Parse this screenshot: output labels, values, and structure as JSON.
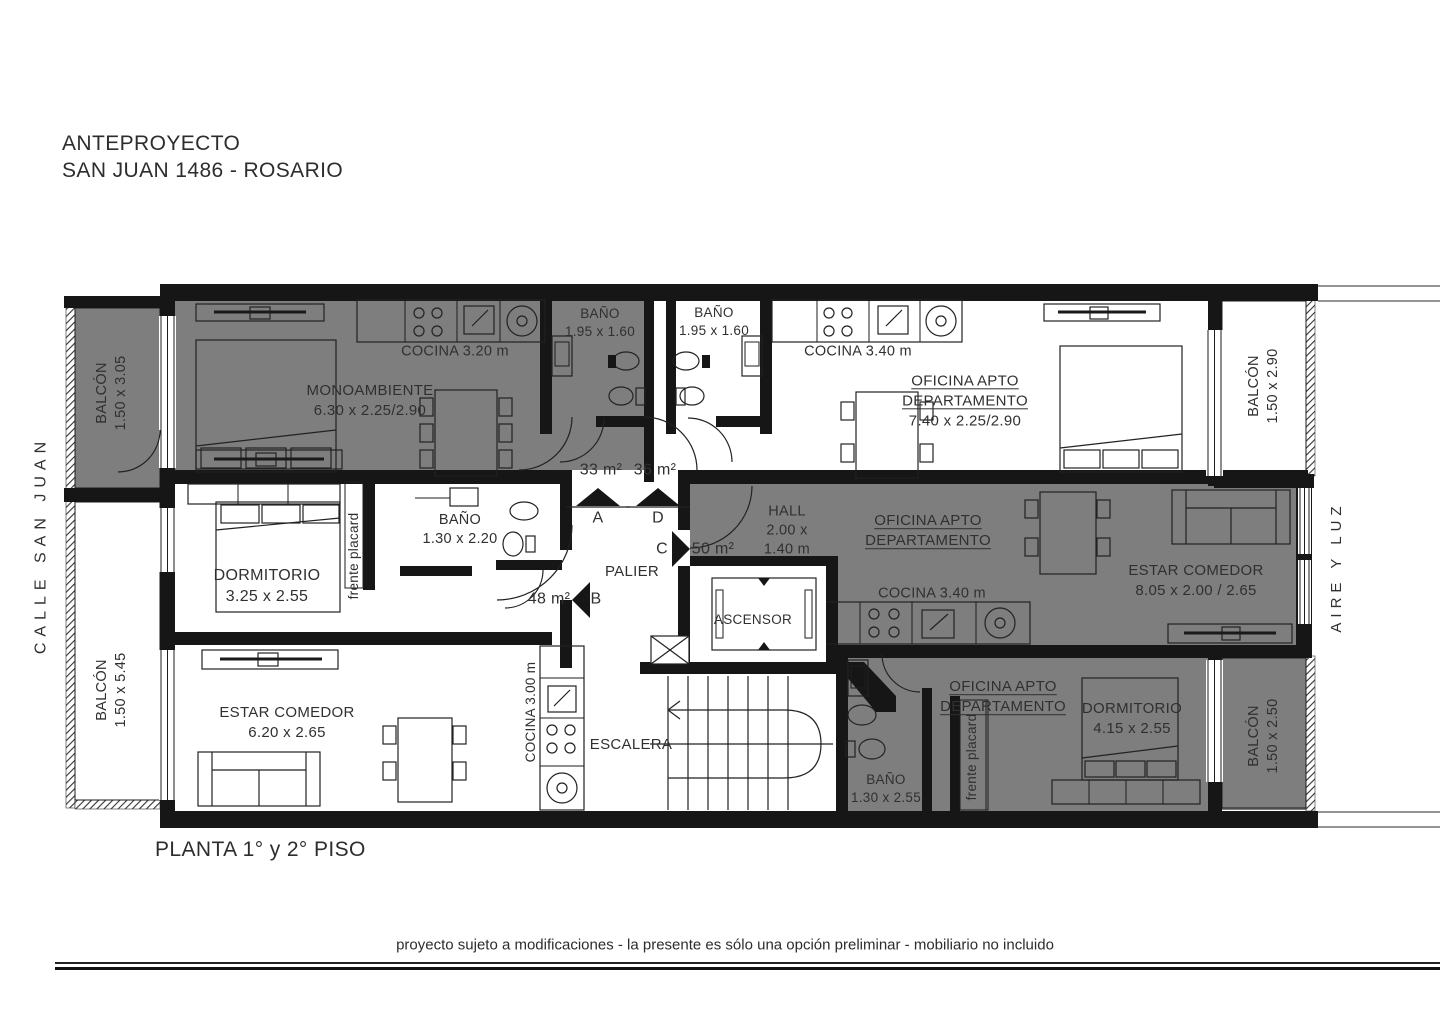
{
  "title": {
    "line1": "ANTEPROYECTO",
    "line2": "SAN JUAN 1486 - ROSARIO"
  },
  "surroundings": {
    "street": "CALLE SAN JUAN",
    "air_shaft": "AIRE Y LUZ"
  },
  "balconies": {
    "left_top": {
      "name": "BALCÓN",
      "dims": "1.50 x 3.05"
    },
    "left_bottom": {
      "name": "BALCÓN",
      "dims": "1.50 x 5.45"
    },
    "right_top": {
      "name": "BALCÓN",
      "dims": "1.50 x 2.90"
    },
    "right_bottom": {
      "name": "BALCÓN",
      "dims": "1.50 x 2.50"
    }
  },
  "unit_a": {
    "area": "33 m²",
    "entry": "A",
    "room": "MONOAMBIENTE",
    "room_dims": "6.30 x 2.25/2.90",
    "kitchen": "COCINA 3.20 m",
    "bath": "BAÑO",
    "bath_dims": "1.95 x 1.60"
  },
  "unit_d": {
    "area": "36 m²",
    "entry": "D",
    "office1": "OFICINA APTO",
    "office2": "DEPARTAMENTO",
    "room_dims": "7.40 x 2.25/2.90",
    "kitchen": "COCINA 3.40 m",
    "bath": "BAÑO",
    "bath_dims": "1.95 x 1.60"
  },
  "unit_b": {
    "area": "48 m²",
    "entry": "B",
    "bedroom": "DORMITORIO",
    "bedroom_dims": "3.25 x 2.55",
    "bath": "BAÑO",
    "bath_dims": "1.30 x 2.20",
    "placard": "frente placard",
    "living": "ESTAR COMEDOR",
    "living_dims": "6.20 x 2.65",
    "kitchen": "COCINA 3.00 m"
  },
  "unit_c": {
    "area": "50 m²",
    "entry": "C",
    "hall": "HALL",
    "hall_dims1": "2.00 x",
    "hall_dims2": "1.40 m",
    "office1": "OFICINA APTO",
    "office2": "DEPARTAMENTO",
    "kitchen": "COCINA 3.40 m",
    "living": "ESTAR COMEDOR",
    "living_dims": "8.05 x 2.00 / 2.65",
    "office1b": "OFICINA APTO",
    "office2b": "DEPARTAMENTO",
    "bedroom": "DORMITORIO",
    "bedroom_dims": "4.15 x 2.55",
    "bath": "BAÑO",
    "bath_dims": "1.30 x 2.55",
    "placard": "frente placard"
  },
  "core": {
    "landing": "PALIER",
    "elevator": "ASCENSOR",
    "stairs": "ESCALERA"
  },
  "footer": {
    "floor": "PLANTA 1° y 2° PISO",
    "disclaimer": "proyecto sujeto a modificaciones - la presente es sólo una opción preliminar - mobiliario no incluido"
  },
  "colors": {
    "shaded_unit": "#7E7E7E",
    "wall": "#161616",
    "text": "#303030"
  }
}
